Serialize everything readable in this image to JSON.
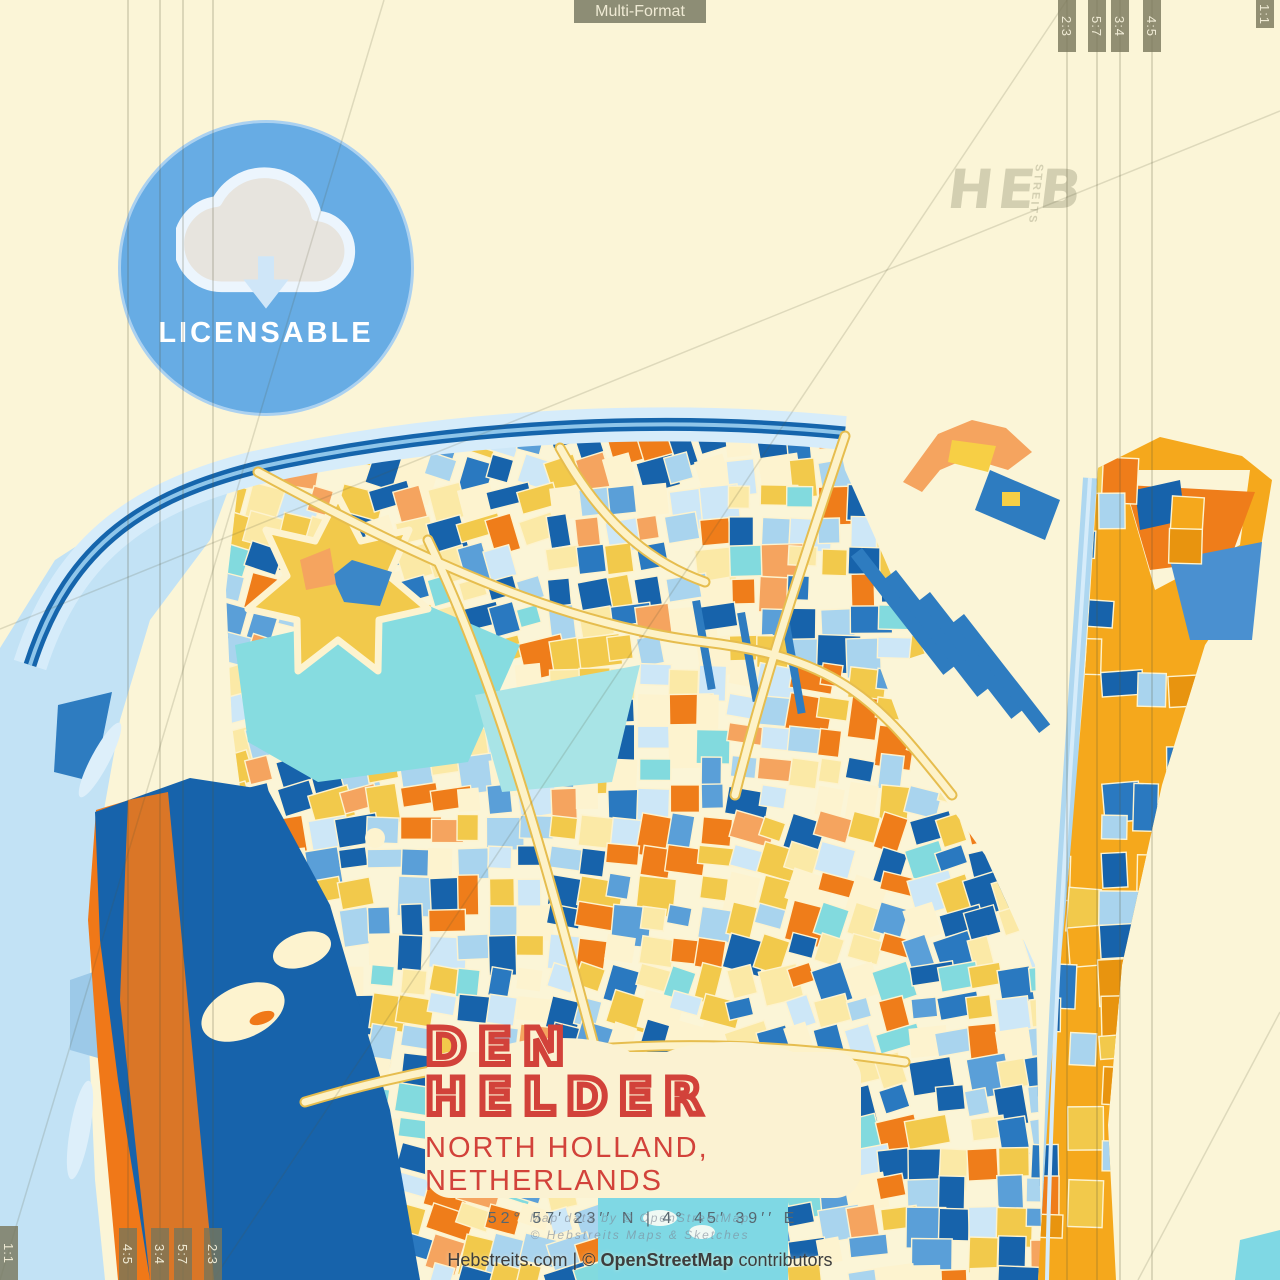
{
  "meta": {
    "format_tab": "Multi-Format"
  },
  "badge": {
    "label": "LICENSABLE",
    "icon": "cloud-download-icon"
  },
  "watermark": {
    "main": "HEB",
    "sub": "STREITS"
  },
  "title_block": {
    "city": "DEN HELDER",
    "region": "NORTH HOLLAND, NETHERLANDS",
    "coordinates": "52°  57′  23′′ N   |   4°  45′  39′′ E"
  },
  "credits": {
    "line1": "Map data by © OpenStreetMap",
    "line2": "© Hebstreits Maps & Sketches",
    "site": "Hebstreits.com",
    "sep": "|",
    "osm_pre": "©",
    "osm": "OpenStreetMap",
    "suffix": "contributors"
  },
  "ratios": {
    "tr": [
      "2:3",
      "5:7",
      "3:4",
      "4:5"
    ],
    "tr_edge": "1:1",
    "bl": [
      "4:5",
      "3:4",
      "5:7",
      "2:3"
    ],
    "bl_edge": "1:1"
  },
  "colors": {
    "paper": "#fbf5d7",
    "badge_blue": "#67ace4",
    "title_red": "#d2423a",
    "sea_light_blue": "#c2e2f5",
    "deep_blue": "#1763ab",
    "gold": "#f2c94b",
    "orange": "#ef7d1a",
    "teal": "#82dade",
    "tab_olive": "#8d8d75"
  }
}
